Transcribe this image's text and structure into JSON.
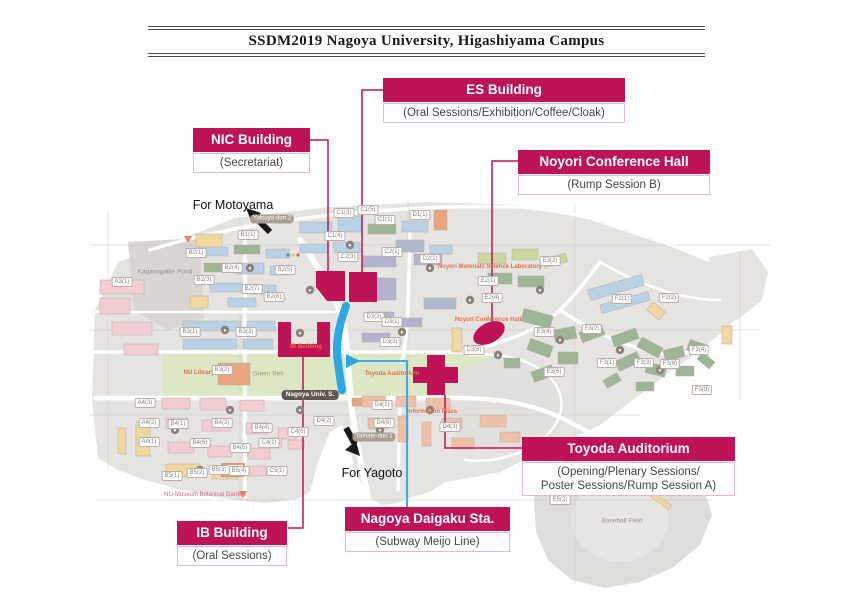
{
  "title": "SSDM2019 Nagoya University, Higashiyama Campus",
  "colors": {
    "accent": "#be1457",
    "subway": "#2ba7e2",
    "map_text_orange": "#e2724b"
  },
  "callouts": {
    "es": {
      "title": "ES Building",
      "subtitle": "(Oral Sessions/Exhibition/Coffee/Cloak)"
    },
    "nic": {
      "title": "NIC Building",
      "subtitle": "(Secretariat)"
    },
    "noyori": {
      "title": "Noyori Conference Hall",
      "subtitle": "(Rump Session B)"
    },
    "toyoda": {
      "title": "Toyoda Auditorium",
      "subtitle": "(Opening/Plenary Sessions/",
      "subtitle2": "Poster Sessions/Rump Session A)"
    },
    "ib": {
      "title": "IB Building",
      "subtitle": "(Oral Sessions)"
    },
    "station": {
      "title": "Nagoya Daigaku Sta.",
      "subtitle": "(Subway Meijo Line)"
    }
  },
  "map": {
    "labels": [
      {
        "text": "For Motoyama",
        "kind": "direction",
        "x": 233,
        "y": 205
      },
      {
        "text": "For Yagoto",
        "kind": "direction",
        "x": 372,
        "y": 473
      },
      {
        "text": "Kagamigaike Pond",
        "kind": "place",
        "x": 165,
        "y": 272
      },
      {
        "text": "Green Belt",
        "kind": "place-green",
        "x": 268,
        "y": 374
      },
      {
        "text": "Baseball Field",
        "kind": "place",
        "x": 622,
        "y": 521
      },
      {
        "text": "NU Library",
        "kind": "orange",
        "x": 199,
        "y": 373
      },
      {
        "text": "Noyori Materials Science Laboratory",
        "kind": "orange",
        "x": 490,
        "y": 267
      },
      {
        "text": "Noyori Conference Hall",
        "kind": "orange",
        "x": 488,
        "y": 320
      },
      {
        "text": "Toyoda Auditorium",
        "kind": "orange",
        "x": 392,
        "y": 374
      },
      {
        "text": "IB Building",
        "kind": "orange",
        "x": 306,
        "y": 347
      },
      {
        "text": "Information Plaza",
        "kind": "orange",
        "x": 432,
        "y": 412
      },
      {
        "text": "NU-Museum Botanical Garden",
        "kind": "pink",
        "x": 205,
        "y": 495
      },
      {
        "text": "Yotsuya-dori 2",
        "kind": "road-badge",
        "x": 272,
        "y": 219
      },
      {
        "text": "Yamate-dori 1",
        "kind": "road-badge",
        "x": 374,
        "y": 437
      },
      {
        "text": "Nagoya Univ. S.",
        "kind": "station-badge",
        "x": 310,
        "y": 395
      },
      {
        "text": "A3(1)",
        "kind": "code-badge",
        "x": 122,
        "y": 282
      },
      {
        "text": "B1(1)",
        "kind": "code-badge",
        "x": 248,
        "y": 235
      },
      {
        "text": "B2(1)",
        "kind": "code-badge",
        "x": 196,
        "y": 253
      },
      {
        "text": "B2(3)",
        "kind": "code-badge",
        "x": 204,
        "y": 280
      },
      {
        "text": "B2(4)",
        "kind": "code-badge",
        "x": 232,
        "y": 268
      },
      {
        "text": "B2(5)",
        "kind": "code-badge",
        "x": 285,
        "y": 270
      },
      {
        "text": "B2(6)",
        "kind": "code-badge",
        "x": 274,
        "y": 297
      },
      {
        "text": "B2(7)",
        "kind": "code-badge",
        "x": 252,
        "y": 289
      },
      {
        "text": "C1(3)",
        "kind": "code-badge",
        "x": 344,
        "y": 213
      },
      {
        "text": "C1(5)",
        "kind": "code-badge",
        "x": 368,
        "y": 210
      },
      {
        "text": "C1(4)",
        "kind": "code-badge",
        "x": 335,
        "y": 236
      },
      {
        "text": "C1(1)",
        "kind": "code-badge",
        "x": 385,
        "y": 220
      },
      {
        "text": "C2(1)",
        "kind": "code-badge",
        "x": 392,
        "y": 252
      },
      {
        "text": "C2(3)",
        "kind": "code-badge",
        "x": 348,
        "y": 257
      },
      {
        "text": "D1(1)",
        "kind": "code-badge",
        "x": 420,
        "y": 215
      },
      {
        "text": "D2(1)",
        "kind": "code-badge",
        "x": 430,
        "y": 259
      },
      {
        "text": "E2(1)",
        "kind": "code-badge",
        "x": 488,
        "y": 281
      },
      {
        "text": "E2(4)",
        "kind": "code-badge",
        "x": 492,
        "y": 298
      },
      {
        "text": "E3(2)",
        "kind": "code-badge",
        "x": 550,
        "y": 261
      },
      {
        "text": "E3(4)",
        "kind": "code-badge",
        "x": 544,
        "y": 332
      },
      {
        "text": "E3(6)",
        "kind": "code-badge",
        "x": 554,
        "y": 372
      },
      {
        "text": "B3(1)",
        "kind": "code-badge",
        "x": 190,
        "y": 332
      },
      {
        "text": "B3(3)",
        "kind": "code-badge",
        "x": 246,
        "y": 332
      },
      {
        "text": "B3(2)",
        "kind": "code-badge",
        "x": 222,
        "y": 370
      },
      {
        "text": "B4(1)",
        "kind": "code-badge",
        "x": 178,
        "y": 424
      },
      {
        "text": "B4(3)",
        "kind": "code-badge",
        "x": 222,
        "y": 423
      },
      {
        "text": "B4(4)",
        "kind": "code-badge",
        "x": 262,
        "y": 428
      },
      {
        "text": "B4(5)",
        "kind": "code-badge",
        "x": 240,
        "y": 448
      },
      {
        "text": "B4(6)",
        "kind": "code-badge",
        "x": 200,
        "y": 443
      },
      {
        "text": "A4(3)",
        "kind": "code-badge",
        "x": 145,
        "y": 403
      },
      {
        "text": "A4(2)",
        "kind": "code-badge",
        "x": 149,
        "y": 423
      },
      {
        "text": "A4(1)",
        "kind": "code-badge",
        "x": 149,
        "y": 442
      },
      {
        "text": "B5(1)",
        "kind": "code-badge",
        "x": 172,
        "y": 476
      },
      {
        "text": "B5(2)",
        "kind": "code-badge",
        "x": 197,
        "y": 473
      },
      {
        "text": "B5(3)",
        "kind": "code-badge",
        "x": 219,
        "y": 470
      },
      {
        "text": "B5(4)",
        "kind": "code-badge",
        "x": 239,
        "y": 471
      },
      {
        "text": "C5(1)",
        "kind": "code-badge",
        "x": 277,
        "y": 471
      },
      {
        "text": "C4(1)",
        "kind": "code-badge",
        "x": 269,
        "y": 443
      },
      {
        "text": "C4(6)",
        "kind": "code-badge",
        "x": 298,
        "y": 432
      },
      {
        "text": "D3(2)",
        "kind": "code-badge",
        "x": 374,
        "y": 317
      },
      {
        "text": "D3(1)",
        "kind": "code-badge",
        "x": 392,
        "y": 322
      },
      {
        "text": "D3(3)",
        "kind": "code-badge",
        "x": 390,
        "y": 342
      },
      {
        "text": "D3(6)",
        "kind": "code-badge",
        "x": 474,
        "y": 350
      },
      {
        "text": "D4(1)",
        "kind": "code-badge",
        "x": 382,
        "y": 405
      },
      {
        "text": "D4(2)",
        "kind": "code-badge",
        "x": 324,
        "y": 421
      },
      {
        "text": "D4(6)",
        "kind": "code-badge",
        "x": 384,
        "y": 423
      },
      {
        "text": "D4(3)",
        "kind": "code-badge",
        "x": 450,
        "y": 427
      },
      {
        "text": "F2(1)",
        "kind": "code-badge",
        "x": 622,
        "y": 299
      },
      {
        "text": "F2(2)",
        "kind": "code-badge",
        "x": 669,
        "y": 298
      },
      {
        "text": "F3(1)",
        "kind": "code-badge",
        "x": 607,
        "y": 363
      },
      {
        "text": "F3(2)",
        "kind": "code-badge",
        "x": 592,
        "y": 329
      },
      {
        "text": "F3(3)",
        "kind": "code-badge",
        "x": 644,
        "y": 363
      },
      {
        "text": "F3(4)",
        "kind": "code-badge",
        "x": 699,
        "y": 350
      },
      {
        "text": "F3(8)",
        "kind": "code-badge",
        "x": 670,
        "y": 364
      },
      {
        "text": "F3(9)",
        "kind": "code-badge",
        "x": 702,
        "y": 390
      },
      {
        "text": "E5(2)",
        "kind": "code-badge",
        "x": 560,
        "y": 500
      }
    ]
  }
}
